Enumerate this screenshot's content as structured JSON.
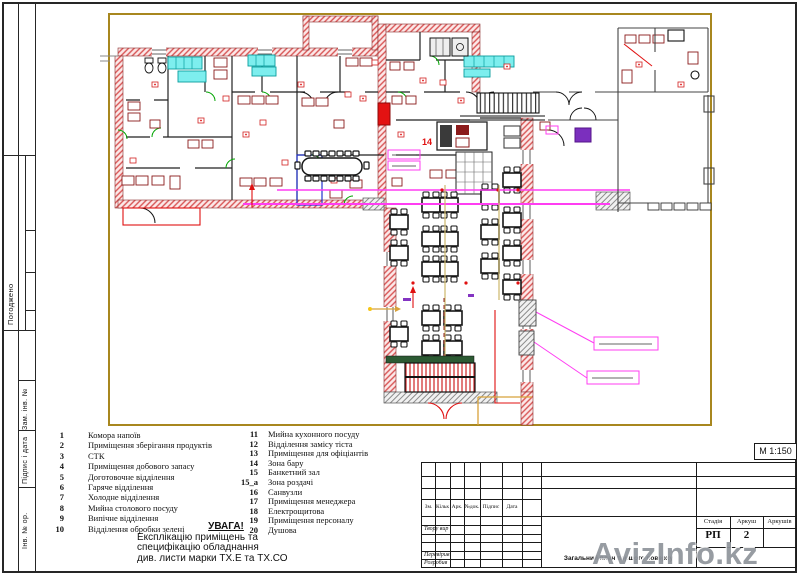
{
  "sidebar": {
    "labels": {
      "agreed": "Погоджено",
      "replace_inv": "Зам. інв. №",
      "sign_date": "Підпис і дата",
      "inv_orig": "Інв. № ор."
    }
  },
  "legend": {
    "items_left": [
      {
        "num": "1",
        "label": "Комора напоїв"
      },
      {
        "num": "2",
        "label": "Приміщення зберігання продуктів"
      },
      {
        "num": "3",
        "label": "СТК"
      },
      {
        "num": "4",
        "label": "Приміщення добового запасу"
      },
      {
        "num": "5",
        "label": "Доготовочне відділення"
      },
      {
        "num": "6",
        "label": "Гаряче відділення"
      },
      {
        "num": "7",
        "label": "Холодне  відділення"
      },
      {
        "num": "8",
        "label": "Мийна столового посуду"
      },
      {
        "num": "9",
        "label": "Випічне відділення"
      },
      {
        "num": "10",
        "label": "Відділення обробки зелені"
      }
    ],
    "items_right": [
      {
        "num": "11",
        "label": "Мийна кухонного посуду"
      },
      {
        "num": "12",
        "label": "Відділення замісу тіста"
      },
      {
        "num": "13",
        "label": "Приміщення для офіціантів"
      },
      {
        "num": "14",
        "label": "Зона бару"
      },
      {
        "num": "15",
        "label": "Банкетний зал"
      },
      {
        "num": "15_а",
        "label": "Зона роздачі"
      },
      {
        "num": "16",
        "label": "Санвузли"
      },
      {
        "num": "17",
        "label": "Приміщення менеджера"
      },
      {
        "num": "18",
        "label": "Електрощитова"
      },
      {
        "num": "19",
        "label": "Приміщення персоналу"
      },
      {
        "num": "20",
        "label": "Душова"
      }
    ]
  },
  "notice": {
    "title": "УВАГА!",
    "line1": "Експлікацію приміщень та",
    "line2": "специфікацію обладнання",
    "line3": "див. листи марки ТХ.Е  та ТХ.СО"
  },
  "title_block": {
    "scale": "М 1:150",
    "stamp_columns": [
      "Зм.",
      "Кільк",
      "Арк.",
      "№док.",
      "Підпис",
      "Дата"
    ],
    "row_labels": [
      "Твору вир",
      "Перевірив",
      "Розробив"
    ],
    "stage_label": "Стадія",
    "sheet_label": "Аркуш",
    "sheets_label": "Аркушів",
    "stage_value": "РП",
    "sheet_value": "2",
    "sheets_value": "",
    "drawing_title": "Загальний план першого поверху"
  },
  "plan": {
    "bar_zone_label": "14"
  },
  "watermark": "AvizInfo.kz"
}
